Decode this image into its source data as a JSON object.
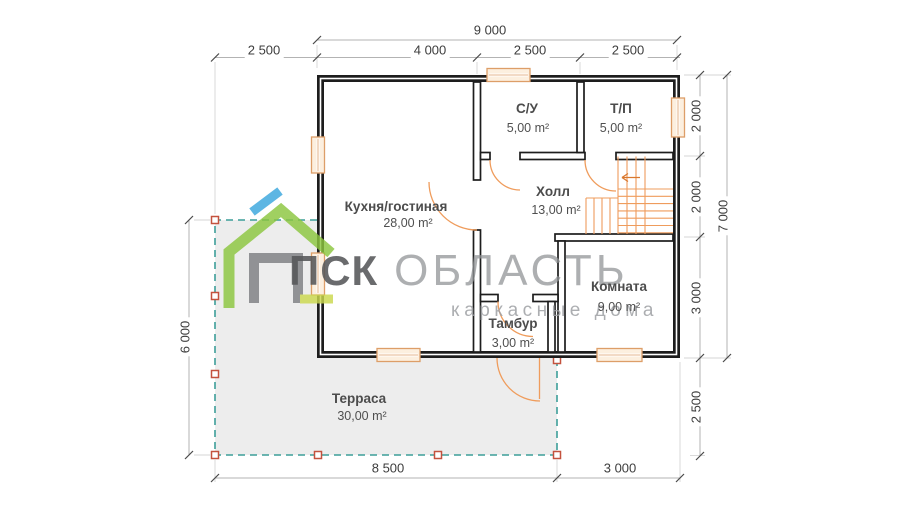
{
  "watermark": {
    "brand_bold": "ПСК",
    "brand_light": "ОБЛАСТЬ",
    "tagline": "каркасные дома"
  },
  "rooms": [
    {
      "name": "С/У",
      "area": "5,00 m²"
    },
    {
      "name": "Т/П",
      "area": "5,00 m²"
    },
    {
      "name": "Кухня/гостиная",
      "area": "28,00 m²"
    },
    {
      "name": "Холл",
      "area": "13,00 m²"
    },
    {
      "name": "Комната",
      "area": "9,00 m²"
    },
    {
      "name": "Тамбур",
      "area": "3,00 m²"
    },
    {
      "name": "Терраса",
      "area": "30,00 m²"
    }
  ],
  "dimensions": {
    "top_total": "9 000",
    "top_segments": [
      "2 500",
      "4 000",
      "2 500",
      "2 500"
    ],
    "right_segments": [
      "2 000",
      "2 000",
      "3 000"
    ],
    "right_total": "7 000",
    "right_lower": "2 500",
    "left_total": "6 000",
    "bottom_segments": [
      "8 500",
      "3 000"
    ]
  },
  "colors": {
    "wall": "#1d1d1d",
    "joinery_orange": "#ef9c5c",
    "window_fill": "#fcefdf",
    "terrace_fill": "#ededed",
    "terrace_dash": "#3d9e99",
    "post_border": "#c4523e",
    "brand_green": "#8cc63f",
    "brand_blue": "#3aa7dd",
    "brand_gray": "#7d7f82",
    "brand_lime": "#cbd94e"
  }
}
